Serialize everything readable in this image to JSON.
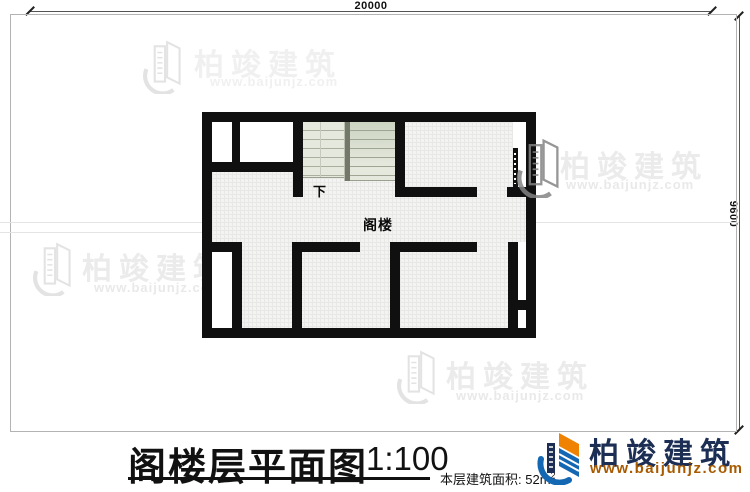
{
  "drawing": {
    "dim_top": "20000",
    "dim_right": "9600",
    "stair_label": "下",
    "room_label": "阁楼"
  },
  "titleblock": {
    "title": "阁楼层平面图",
    "scale": "1:100",
    "area_label": "本层建筑面积:",
    "area_value": "52m",
    "area_sup": "2"
  },
  "logo": {
    "name": "柏竣建筑",
    "url": "www.baijunjz.com"
  },
  "watermark": {
    "brand": "柏竣建筑",
    "url": "www.baijunjz.com"
  },
  "colors": {
    "wall": "#101010",
    "stair_fill": "#e5e8dd",
    "stair_tread_line": "#a9af9f",
    "floor_grid": "#e8e8e6",
    "logo_navy": "#1c2e54",
    "logo_blue": "#1467b3",
    "logo_orange": "#ef8200",
    "logo_url_color": "#a85a00",
    "watermark_gray": "#ebebeb"
  }
}
